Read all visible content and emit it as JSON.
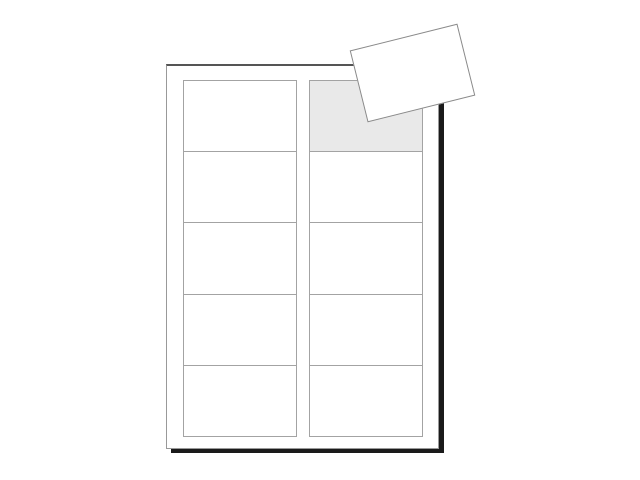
{
  "scene": {
    "background_color": "#ffffff",
    "description": "blank-label-sheet-with-one-peeled-label"
  },
  "sheet": {
    "columns": 2,
    "rows": 5,
    "label_count": 10,
    "peeled_slot": {
      "row": 0,
      "column": 1
    },
    "colors": {
      "background": "#ffffff",
      "paper": "#ffffff",
      "outline_top": "#555555",
      "outline_side": "#999999",
      "shadow": "#1a1a1a",
      "cell_border": "#a3a3a3",
      "peeled_slot_fill": "#e9e9e9",
      "peeled_label_border": "#8a8a8a"
    }
  }
}
